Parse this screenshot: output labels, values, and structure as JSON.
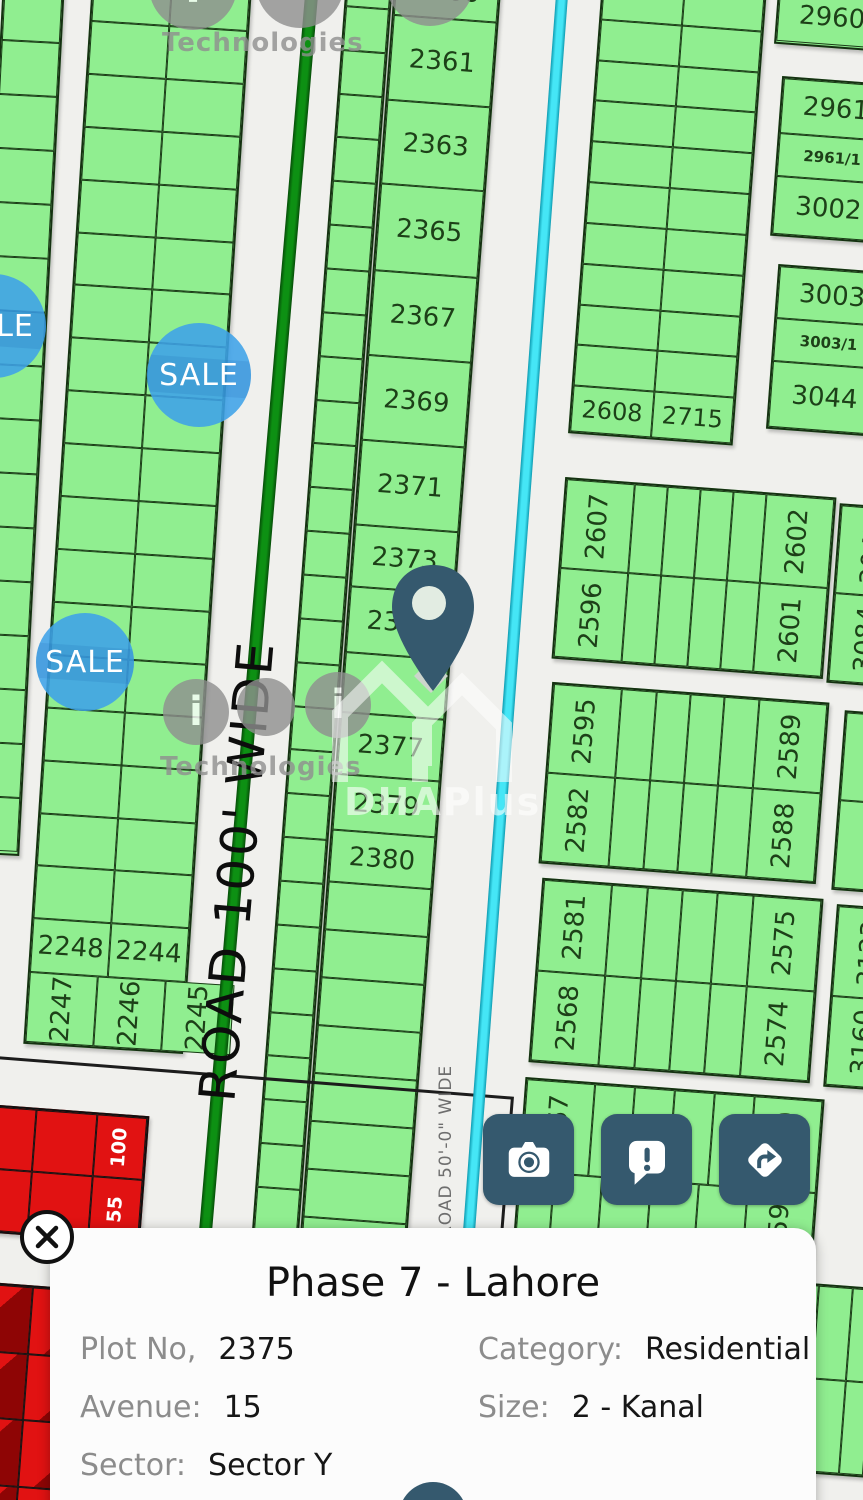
{
  "labels": {
    "sale": "SALE",
    "road_main": "ROAD 100' WIDE",
    "road_side": "ROAD 50'-0\" WIDE"
  },
  "watermarks": {
    "tech": "Technologies",
    "dha": "DHAPlus",
    "logo_glyph": "i"
  },
  "plots": {
    "center_column": [
      "2360",
      "2361",
      "2363",
      "2365",
      "2367",
      "2369",
      "2371",
      "2373",
      "2375",
      "",
      "2377",
      "2379",
      "2380"
    ],
    "left_block_row": [
      "2248",
      "2244"
    ],
    "left_block_bottom": [
      "2247",
      "2246",
      "2245"
    ],
    "top_right_block": [
      "2608",
      "2715"
    ],
    "right_edge_a": [
      "2960"
    ],
    "right_edge_b": [
      "2961",
      "2961/1",
      "3002"
    ],
    "right_edge_c": [
      "3003",
      "3003/1",
      "3044"
    ],
    "row_e": {
      "top": [
        "2607",
        "2602"
      ],
      "bottom": [
        "2596",
        "2601"
      ]
    },
    "row_e2": {
      "top": [
        "3045"
      ],
      "bottom": [
        "3084"
      ]
    },
    "row_f": {
      "top": [
        "2595",
        "2589"
      ],
      "bottom": [
        "2582",
        "2588"
      ]
    },
    "row_g": {
      "top": [
        "2581",
        "2575"
      ],
      "bottom": [
        "2568",
        "2574"
      ]
    },
    "row_g2": {
      "top": [
        "3123"
      ],
      "bottom": [
        "3160"
      ]
    },
    "row_h": {
      "top": [
        "2567",
        "2560"
      ],
      "bottom": [
        "2559"
      ]
    },
    "row_i": {
      "top": [
        "2544"
      ],
      "bottom": [
        "2543"
      ]
    },
    "red_block": [
      "100",
      "55"
    ],
    "red_block2": [
      "3"
    ]
  },
  "card": {
    "title": "Phase 7 - Lahore",
    "fields": [
      {
        "label": "Plot No,",
        "value": "2375"
      },
      {
        "label": "Category:",
        "value": "Residential"
      },
      {
        "label": "Avenue:",
        "value": "15"
      },
      {
        "label": "Size:",
        "value": "2 - Kanal"
      },
      {
        "label": "Sector:",
        "value": "Sector Y"
      }
    ]
  },
  "icons": {
    "camera": "camera-icon",
    "report": "report-bubble-icon",
    "directions": "directions-icon",
    "close": "close-icon",
    "pin": "map-pin-icon"
  },
  "colors": {
    "accent": "#35596e",
    "sale_blue": "#3da2e8",
    "plot_green": "#90ee90",
    "sold_red": "#e11212",
    "canal_cyan": "#45e6f6",
    "road_green": "#0d9013"
  }
}
